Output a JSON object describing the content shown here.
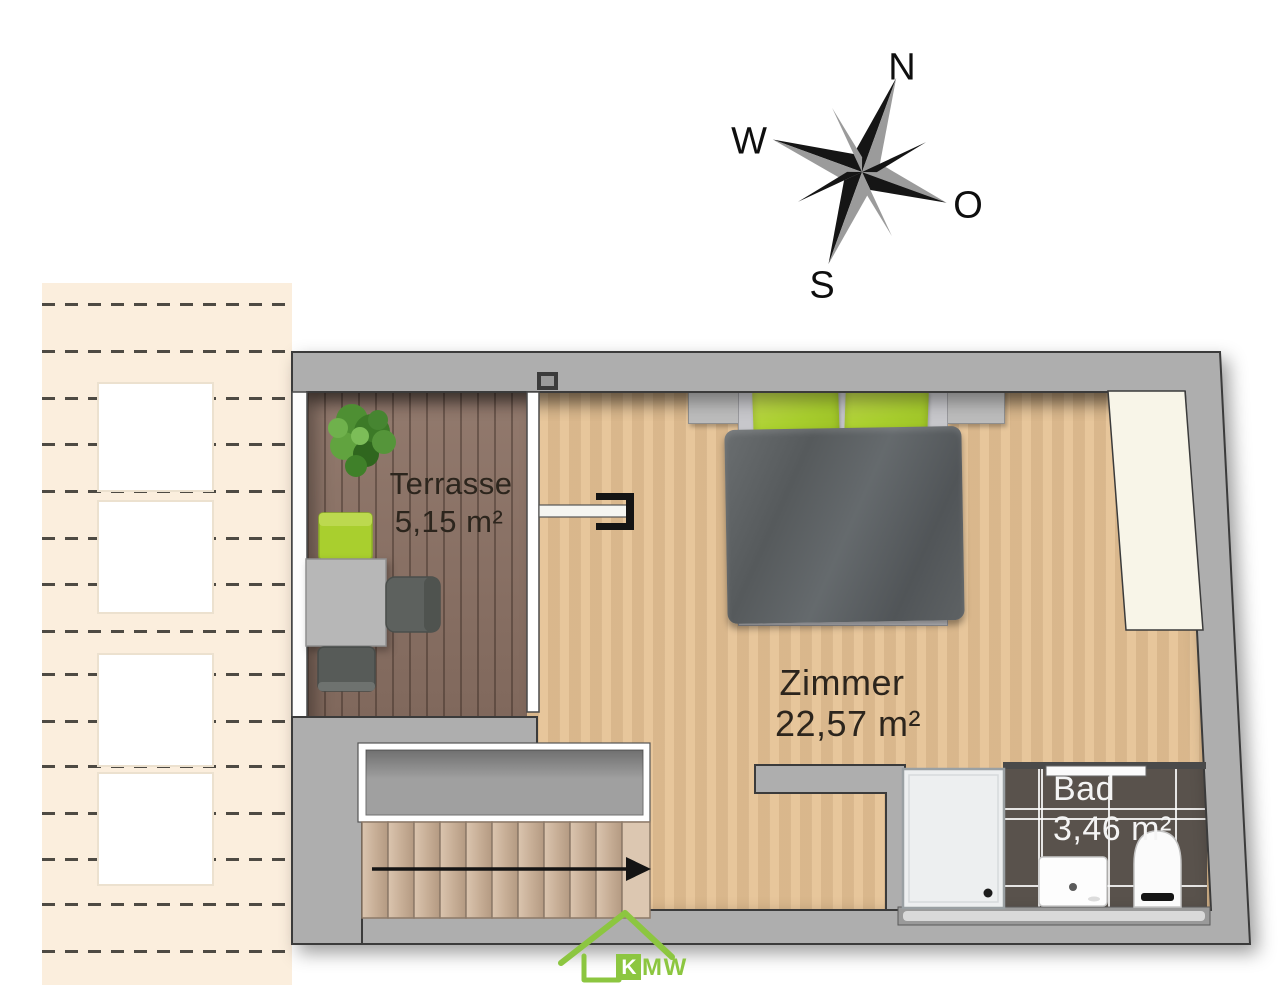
{
  "compass": {
    "north": "N",
    "west": "W",
    "east": "O",
    "south": "S"
  },
  "rooms": {
    "terrasse": {
      "name": "Terrasse",
      "area": "5,15 m²"
    },
    "zimmer": {
      "name": "Zimmer",
      "area": "22,57 m²"
    },
    "bad": {
      "name": "Bad",
      "area": "3,46 m²"
    }
  },
  "logo": {
    "k": "K",
    "m": "M",
    "w": "W"
  },
  "colors": {
    "wall": "#aeaeae",
    "wood": "#e5c193",
    "deck": "#8b7164",
    "tile": "#59524c",
    "roof": "#fbeedd",
    "green": "#a9cf2e",
    "logo_green": "#8cc640",
    "void": "#a0a0a0",
    "tread": "#cbb29a"
  }
}
